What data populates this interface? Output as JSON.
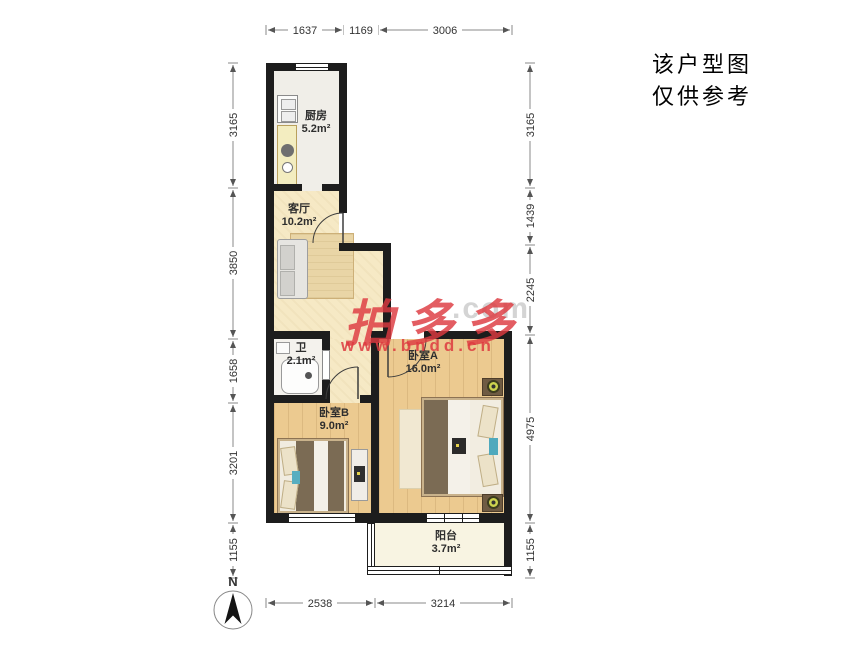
{
  "note": {
    "line1": "该户型图",
    "line2": "仅供参考"
  },
  "compass": {
    "label": "N"
  },
  "watermark": {
    "brand": "拍多多",
    "ghost": ".com",
    "url": "www.bndd.cn"
  },
  "rooms": {
    "kitchen": {
      "name": "厨房",
      "area": "5.2m²"
    },
    "living": {
      "name": "客厅",
      "area": "10.2m²"
    },
    "bath": {
      "name": "卫",
      "area": "2.1m²"
    },
    "bedroom_b": {
      "name": "卧室B",
      "area": "9.0m²"
    },
    "bedroom_a": {
      "name": "卧室A",
      "area": "16.0m²"
    },
    "balcony": {
      "name": "阳台",
      "area": "3.7m²"
    }
  },
  "dimensions_mm": {
    "top": [
      "1637",
      "1169",
      "3006"
    ],
    "left": [
      "3165",
      "3850",
      "1658",
      "3201",
      "1155"
    ],
    "right": [
      "3165",
      "1439",
      "2245",
      "4975",
      "1155"
    ],
    "bottom": [
      "2538",
      "3214"
    ]
  },
  "colors": {
    "wall": "#1d1d1d",
    "floor_wood": "#ecca90",
    "floor_living": "#f6e9c5",
    "floor_kitchen": "#f0eee8",
    "floor_bath": "#f4f2ed",
    "floor_balcony": "#f8f4e2",
    "watermark_red": "#dd3940",
    "dimension_line": "#888888"
  }
}
